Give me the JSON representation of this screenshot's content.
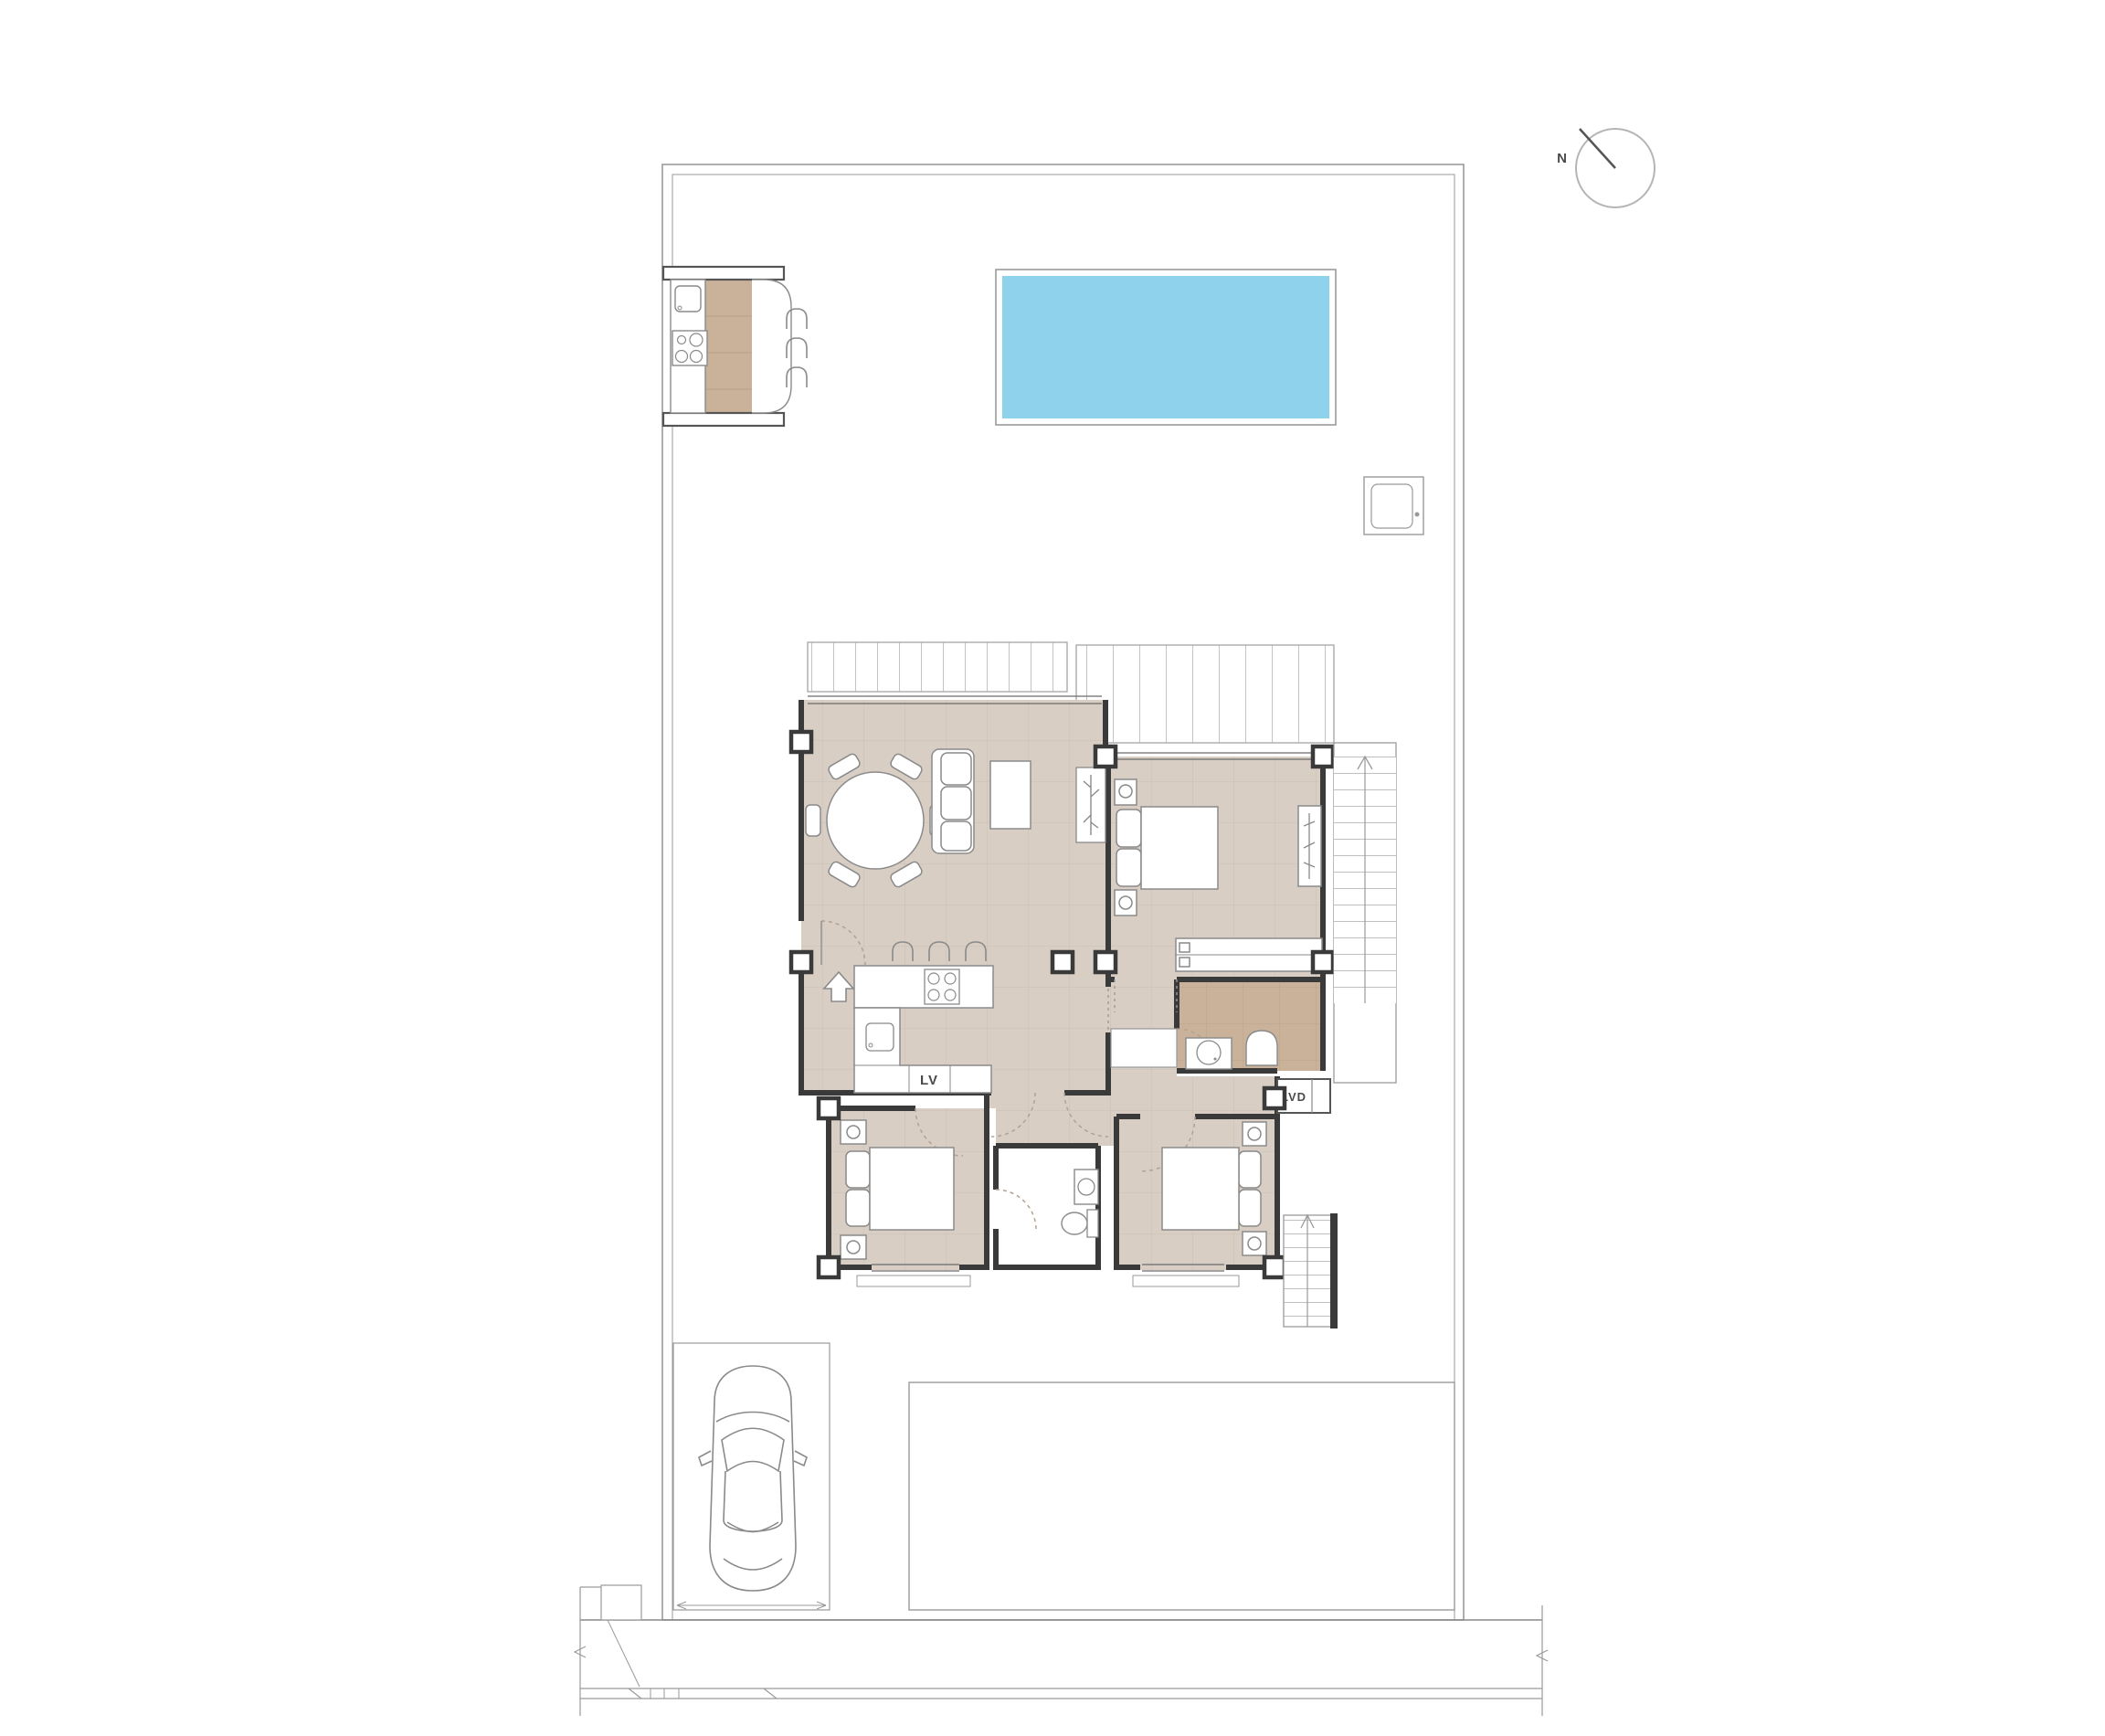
{
  "plan": {
    "title": "villa-site-floor-plan",
    "labels": {
      "north": "N",
      "dishwasher": "LV",
      "laundry": "LVD"
    },
    "colors": {
      "floor_main": "#d8cec4",
      "floor_tan": "#c9b299",
      "pool_water": "#8ed2ec",
      "wall": "#3a3a3a",
      "line": "#8a8a8a",
      "boundary": "#9a9a9a",
      "slat": "#c4c4c4",
      "dash": "#b3a293"
    },
    "features": [
      "compass",
      "swimming-pool",
      "outdoor-kitchen",
      "bar-stools",
      "technical-box",
      "pergola",
      "living-dining-room",
      "dining-table",
      "sofa",
      "coffee-table",
      "kitchen-island",
      "cooktop",
      "kitchen-sink",
      "dishwasher",
      "entry-door",
      "master-bedroom",
      "double-bed",
      "nightstand",
      "wardrobe",
      "bathroom",
      "shower",
      "toilet",
      "washbasin",
      "laundry-closet",
      "bedroom",
      "hallway",
      "exterior-stairs-up",
      "exterior-stairs-down",
      "car",
      "parking-space",
      "patio",
      "street-sidewalk",
      "plot-boundary",
      "gate"
    ]
  }
}
